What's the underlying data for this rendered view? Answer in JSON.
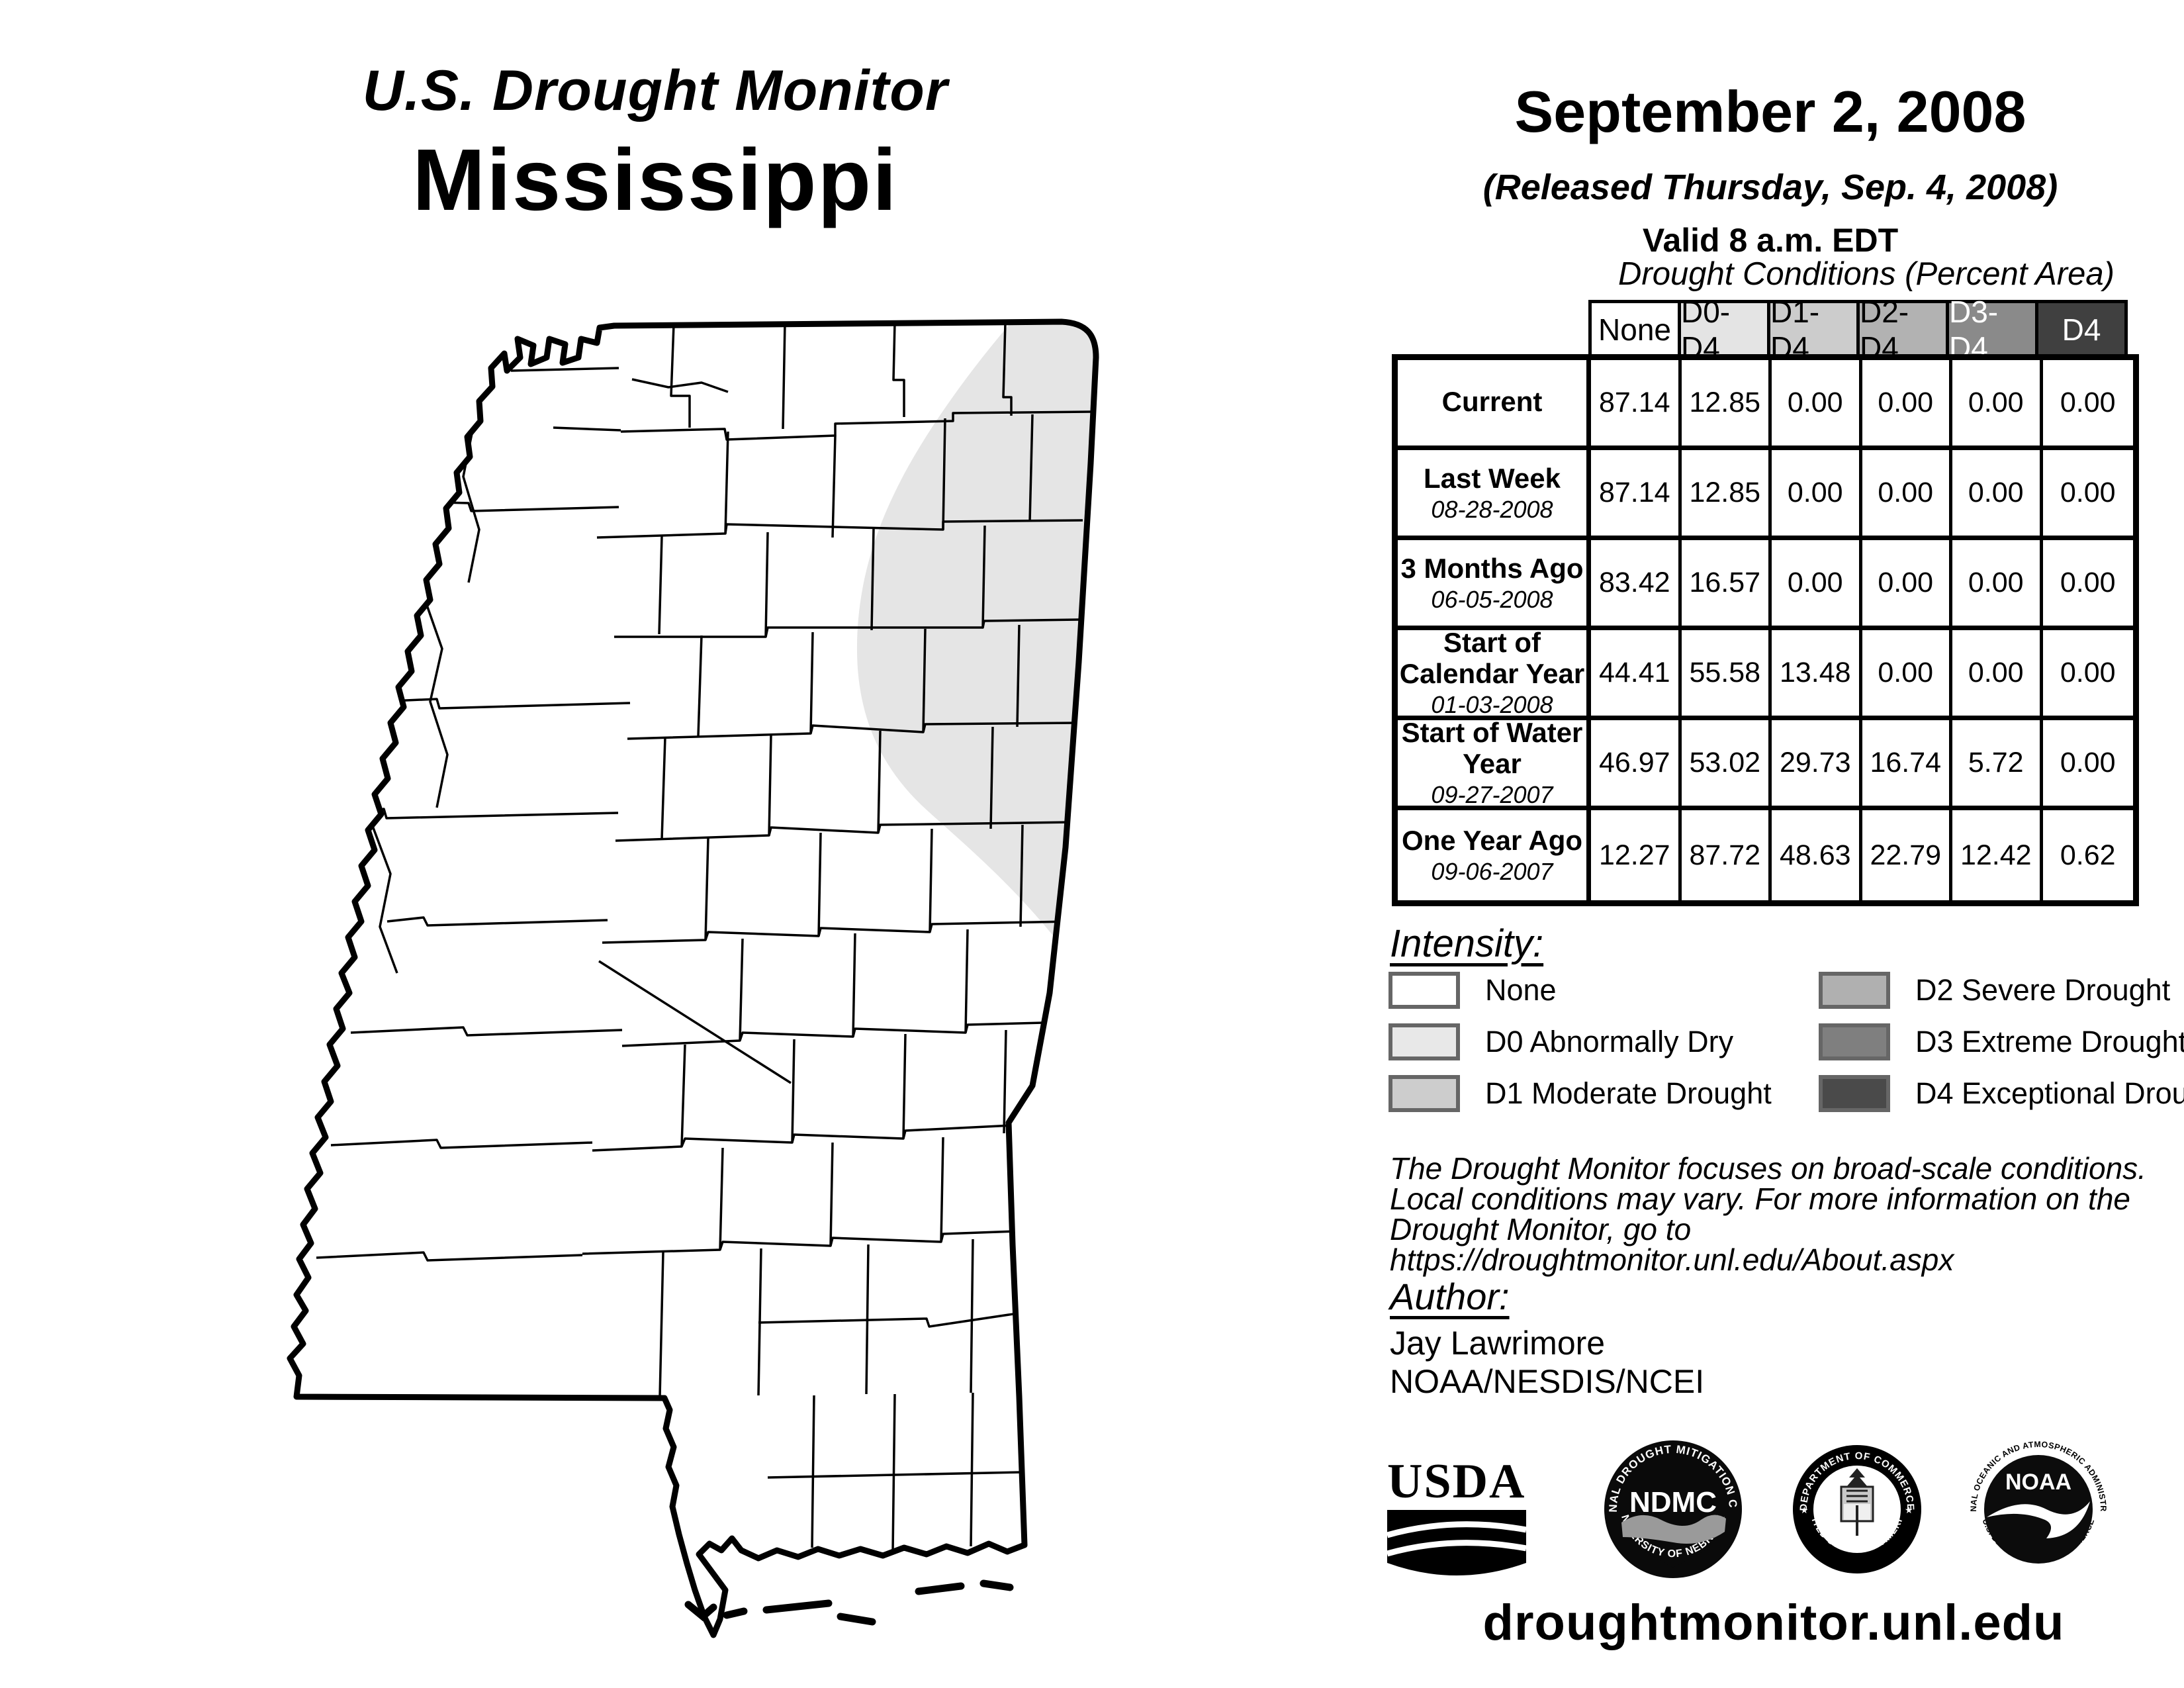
{
  "title": {
    "line1": "U.S. Drought Monitor",
    "line2": "Mississippi"
  },
  "date_block": {
    "date": "September 2, 2008",
    "released": "(Released Thursday, Sep. 4, 2008)",
    "valid": "Valid 8 a.m. EDT"
  },
  "table": {
    "caption": "Drought Conditions (Percent Area)",
    "columns": [
      "None",
      "D0-D4",
      "D1-D4",
      "D2-D4",
      "D3-D4",
      "D4"
    ],
    "header_colors": [
      "#ffffff",
      "#e4e4e4",
      "#cccccc",
      "#b2b2b2",
      "#8a8a8a",
      "#404040"
    ],
    "header_text_colors": [
      "#000000",
      "#000000",
      "#000000",
      "#000000",
      "#ffffff",
      "#ffffff"
    ],
    "rows": [
      {
        "label": "Current",
        "date": "",
        "values": [
          "87.14",
          "12.85",
          "0.00",
          "0.00",
          "0.00",
          "0.00"
        ]
      },
      {
        "label": "Last Week",
        "date": "08-28-2008",
        "values": [
          "87.14",
          "12.85",
          "0.00",
          "0.00",
          "0.00",
          "0.00"
        ]
      },
      {
        "label": "3 Months Ago",
        "date": "06-05-2008",
        "values": [
          "83.42",
          "16.57",
          "0.00",
          "0.00",
          "0.00",
          "0.00"
        ]
      },
      {
        "label": "Start of Calendar Year",
        "date": "01-03-2008",
        "values": [
          "44.41",
          "55.58",
          "13.48",
          "0.00",
          "0.00",
          "0.00"
        ]
      },
      {
        "label": "Start of Water Year",
        "date": "09-27-2007",
        "values": [
          "46.97",
          "53.02",
          "29.73",
          "16.74",
          "5.72",
          "0.00"
        ]
      },
      {
        "label": "One Year Ago",
        "date": "09-06-2007",
        "values": [
          "12.27",
          "87.72",
          "48.63",
          "22.79",
          "12.42",
          "0.62"
        ]
      }
    ]
  },
  "legend": {
    "title": "Intensity:",
    "items": [
      {
        "label": "None",
        "color": "#ffffff"
      },
      {
        "label": "D0 Abnormally Dry",
        "color": "#e8e8e8"
      },
      {
        "label": "D1 Moderate Drought",
        "color": "#cdcdcd"
      },
      {
        "label": "D2 Severe Drought",
        "color": "#b0b0b0"
      },
      {
        "label": "D3 Extreme Drought",
        "color": "#7f7f7f"
      },
      {
        "label": "D4 Exceptional Drought",
        "color": "#4a4a4a"
      }
    ]
  },
  "disclaimer": {
    "line1": "The Drought Monitor focuses on broad-scale conditions.",
    "line2": "Local conditions may vary. For more information on the",
    "line3": "Drought Monitor, go to https://droughtmonitor.unl.edu/About.aspx"
  },
  "author": {
    "title": "Author:",
    "name": "Jay Lawrimore",
    "org": "NOAA/NESDIS/NCEI"
  },
  "logos": {
    "usda": "USDA",
    "ndmc": "NDMC",
    "ndmc_top": "NATIONAL DROUGHT MITIGATION CENTER",
    "ndmc_bottom": "UNIVERSITY OF NEBRASKA",
    "doc_top": "DEPARTMENT OF COMMERCE",
    "doc_bottom": "UNITED STATES OF AMERICA",
    "noaa": "NOAA",
    "noaa_top": "NATIONAL OCEANIC AND ATMOSPHERIC ADMINISTRATION",
    "noaa_bottom": "U.S. DEPARTMENT OF COMMERCE"
  },
  "url": "droughtmonitor.unl.edu",
  "map": {
    "d0_fill": "#e5e5e5",
    "shaded_condition": "D0 Abnormally Dry (northeast Mississippi)"
  }
}
